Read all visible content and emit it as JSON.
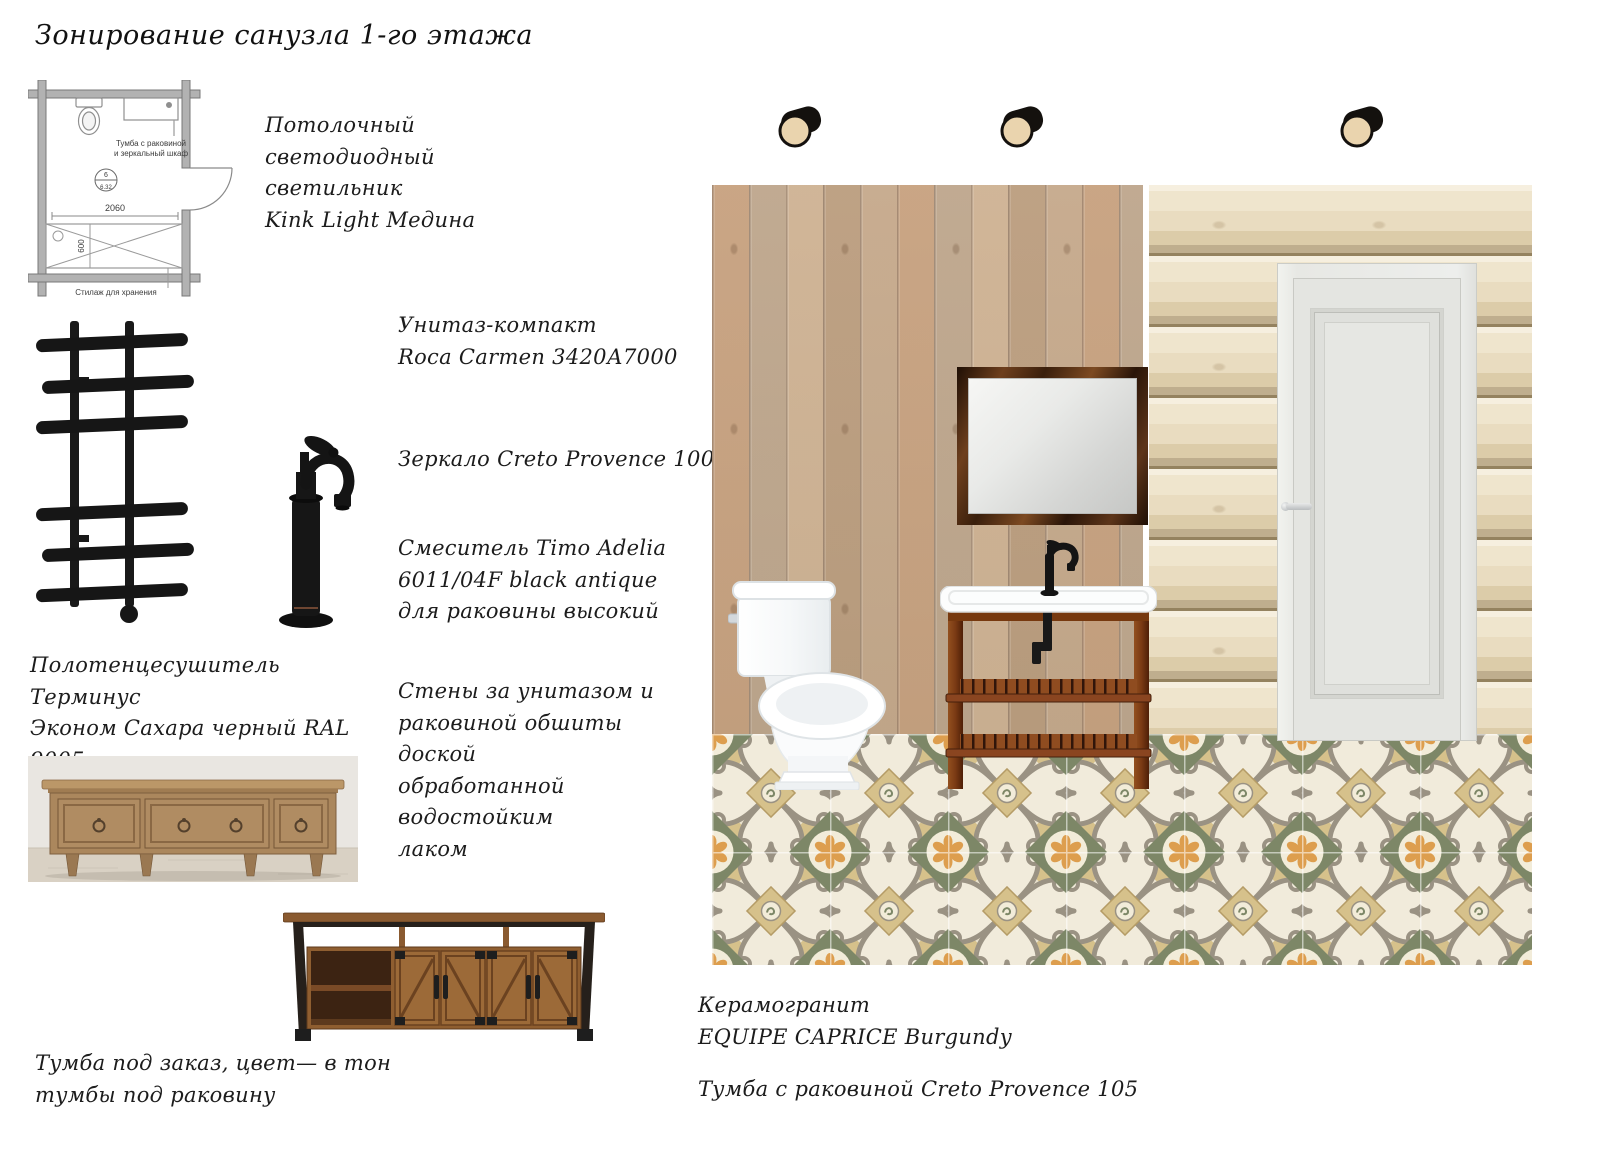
{
  "title": "Зонирование санузла 1-го этажа",
  "floor_plan": {
    "vanity_label_line1": "Тумба с раковиной",
    "vanity_label_line2": "и зеркальный шкаф",
    "room_number": "6",
    "room_area": "6.32",
    "width_dimension": "2060",
    "depth_dimension": "600",
    "storage_label": "Стилаж для хранения"
  },
  "notes": {
    "ceiling_light": "Потолочный светодиодный\nсветильник\nKink Light Медина",
    "toilet": "Унитаз-компакт\nRoca Carmen 3420А7000",
    "mirror": "Зеркало Creto Provence 100",
    "mixer": "Смеситель Timo Adelia\n6011/04F black antique\nдля раковины высокий",
    "towel_rail": "Полотенцесушитель Терминус\nЭконом Сахара черный RAL 9005\n(электрический)",
    "walls": "Стены за унитазом и\nраковиной обшиты доской\nобработанной водостойким\nлаком",
    "custom_cabinet": "Тумба под заказ, цвет— в тон\nтумбы под раковину",
    "tile": "Керамогранит\nEQUIPE CAPRICE  Burgundy",
    "vanity": "Тумба с раковиной Creto Provence 105"
  },
  "colors": {
    "plank_wall": "#c3a98c",
    "log_wall": "#eee4cc",
    "tile_cream": "#eae2cd",
    "tile_green": "#7d8767",
    "tile_orange": "#dd9e4e",
    "tile_taupe": "#9a9283",
    "tile_khaki": "#d6c18b",
    "vanity_wood": "#8a4520",
    "mirror_frame": "#3a1f0c",
    "fixture_black": "#161616",
    "door_white": "#e7e8e4"
  }
}
